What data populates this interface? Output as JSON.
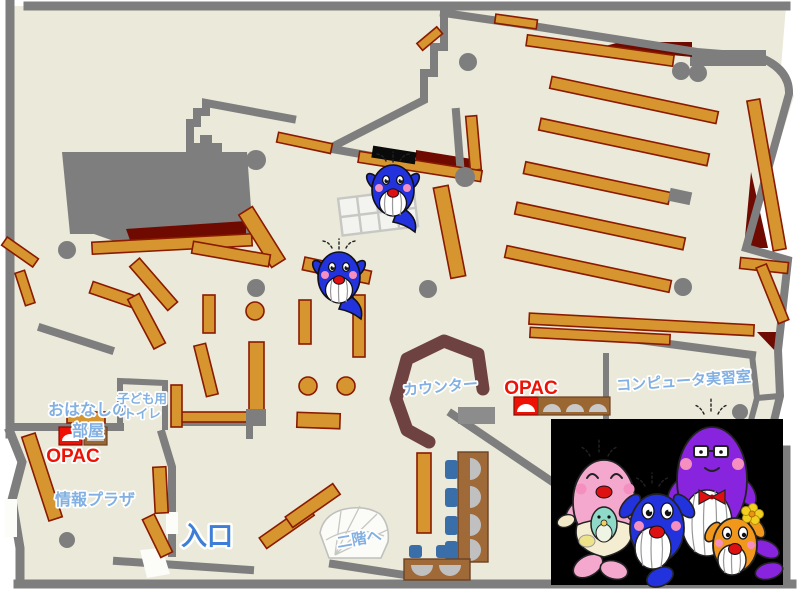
{
  "map": {
    "labels": {
      "storytelling_room_l1": "おはなしの",
      "storytelling_room_l2": "部屋",
      "kids_toilet_l1": "子ども用",
      "kids_toilet_l2": "トイレ",
      "opac_left": "OPAC",
      "info_plaza": "情報プラザ",
      "entrance": "入口",
      "stairs_up": "二階へ",
      "counter": "カウンター",
      "opac_right": "OPAC",
      "computer_room": "コンピュータ実習室"
    }
  },
  "colors": {
    "floor": "#EBE9D9",
    "wall": "#7E7E7E",
    "shelf": "#D6952F",
    "shelf_border": "#8A1A00",
    "dark_red": "#6E0A00",
    "counter": "#6F4242",
    "desk_brown": "#A06A38",
    "chair_blue": "#3A6EA8",
    "monitor_gray": "#C0C0C0",
    "label_blue": "#82B0E2",
    "entrance_blue": "#3E7ED6",
    "opac_red": "#EE1206",
    "whale_blue": "#2233DD",
    "whale_pink": "#F5A8CE",
    "whale_purple": "#8824DD",
    "whale_orange": "#F0971C",
    "whale_teal": "#8FD9C8"
  }
}
